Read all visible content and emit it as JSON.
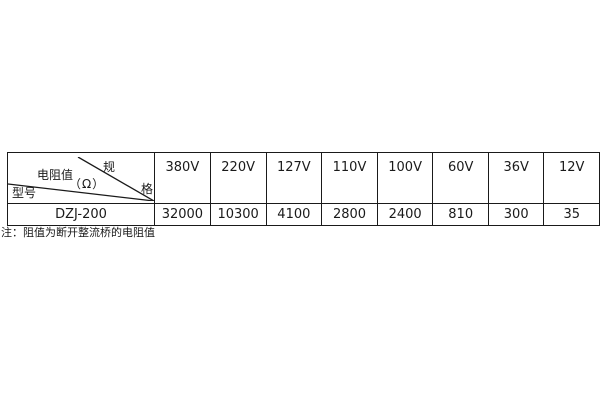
{
  "page": {
    "background": "#ffffff",
    "text_color": "#1a1a1a",
    "border_color": "#1a1a1a"
  },
  "table": {
    "corner": {
      "spec_char_top": "规",
      "spec_char_bottom": "格",
      "resistance_label": "电阻值",
      "resistance_unit": "（Ω）",
      "model_label": "型号"
    },
    "voltage_headers": [
      "380V",
      "220V",
      "127V",
      "110V",
      "100V",
      "60V",
      "36V",
      "12V"
    ],
    "model": "DZJ-200",
    "resistance_values": [
      "32000",
      "10300",
      "4100",
      "2800",
      "2400",
      "810",
      "300",
      "35"
    ]
  },
  "note": "注：阻值为断开整流桥的电阻值"
}
